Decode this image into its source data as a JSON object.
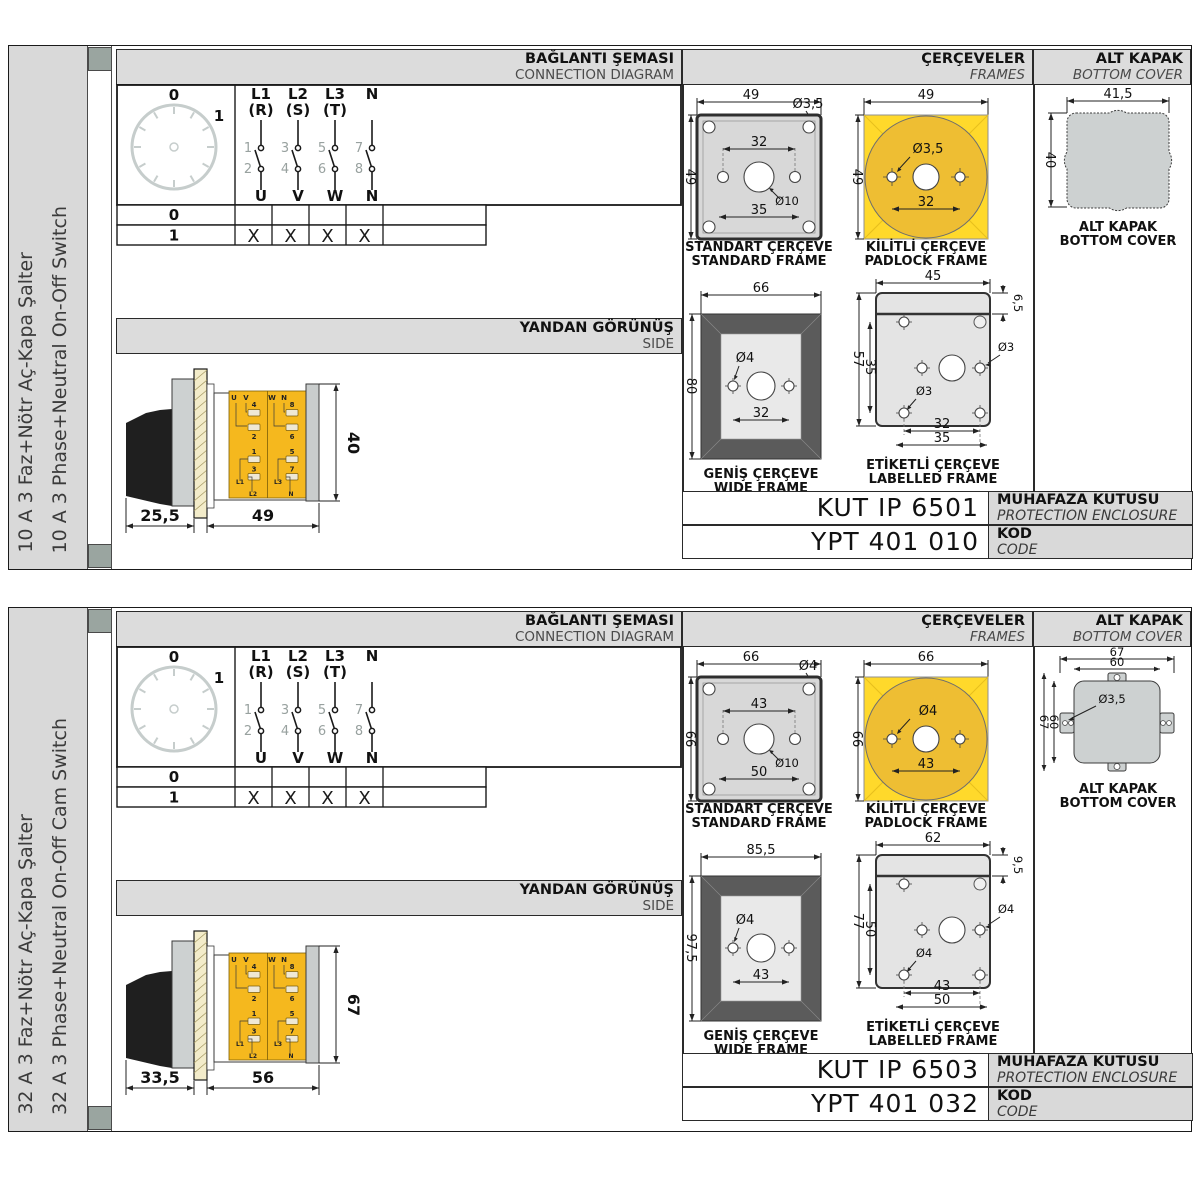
{
  "colors": {
    "panel_grey": "#d9d9d9",
    "header_grey": "#dcdcdc",
    "tab_grey": "#9aa5a0",
    "accent_yellow": "#ffd92b",
    "circle_yellow": "#eebe33",
    "terminal_yellow": "#f5b81e",
    "wide_frame_dark": "#5b5b5b",
    "line_dark": "#1a1a1a",
    "dim_grey": "#98a19f",
    "cover_grey": "#cdd1d1"
  },
  "products": [
    {
      "sidebar": {
        "tr": "10 A 3 Faz+Nötr Aç-Kapa Şalter",
        "en": "10 A 3 Phase+Neutral On-Off Switch"
      },
      "hdr": {
        "conn_tr": "BAĞLANTI ŞEMASI",
        "conn_en": "CONNECTION DIAGRAM",
        "frames_tr": "ÇERÇEVELER",
        "frames_en": "FRAMES",
        "cover_tr": "ALT KAPAK",
        "cover_en": "BOTTOM COVER",
        "side_tr": "YANDAN GÖRÜNÜŞ",
        "side_en": "SIDE"
      },
      "dial": {
        "off": "0",
        "on": "1"
      },
      "poles": {
        "p1": "L1",
        "p1b": "(R)",
        "p2": "L2",
        "p2b": "(S)",
        "p3": "L3",
        "p3b": "(T)",
        "p4": "N",
        "p4b": "",
        "c1": "1",
        "c2": "2",
        "c3": "3",
        "c4": "4",
        "c5": "5",
        "c6": "6",
        "c7": "7",
        "c8": "8",
        "o1": "U",
        "o2": "V",
        "o3": "W",
        "o4": "N"
      },
      "table": {
        "r0": "0",
        "r1": "1",
        "m1": "X",
        "m2": "X",
        "m3": "X",
        "m4": "X"
      },
      "side": {
        "d_left": "25,5",
        "d_w": "49",
        "d_h": "40",
        "u": "U",
        "v": "V",
        "w": "W",
        "n": "N",
        "n1": "1",
        "n2": "2",
        "n3": "3",
        "n4": "4",
        "n5": "5",
        "n6": "6",
        "n7": "7",
        "n8": "8",
        "l1": "L1",
        "l2": "L2",
        "l3": "L3",
        "ln": "N"
      },
      "std": {
        "tr": "STANDART ÇERÇEVE",
        "en": "STANDARD FRAME",
        "w": "49",
        "h": "49",
        "hole": "Ø3,5",
        "inner": "32",
        "center": "Ø10",
        "outer": "35"
      },
      "pad": {
        "tr": "KİLİTLİ ÇERÇEVE",
        "en": "PADLOCK FRAME",
        "w": "49",
        "h": "49",
        "hole": "Ø3,5",
        "inner": "32"
      },
      "wide": {
        "tr": "GENİŞ ÇERÇEVE",
        "en": "WIDE FRAME",
        "w": "66",
        "h": "80",
        "hole": "Ø4",
        "inner": "32"
      },
      "lab": {
        "tr": "ETİKETLİ ÇERÇEVE",
        "en": "LABELLED FRAME",
        "w": "45",
        "strip": "6,5",
        "h": "57",
        "h2": "35",
        "hole1": "Ø3",
        "hole2": "Ø3",
        "b1": "32",
        "b2": "35"
      },
      "cover": {
        "tr": "ALT KAPAK",
        "en": "BOTTOM COVER",
        "variant": "plain",
        "w": "41,5",
        "h": "40"
      },
      "codes": {
        "kut": "KUT IP 6501",
        "enc_tr": "MUHAFAZA KUTUSU",
        "enc_en": "PROTECTION ENCLOSURE",
        "ypt": "YPT 401 010",
        "kod_tr": "KOD",
        "kod_en": "CODE"
      }
    },
    {
      "sidebar": {
        "tr": "32 A 3 Faz+Nötr Aç-Kapa Şalter",
        "en": "32 A 3 Phase+Neutral On-Off Cam Switch"
      },
      "hdr": {
        "conn_tr": "BAĞLANTI ŞEMASI",
        "conn_en": "CONNECTION DIAGRAM",
        "frames_tr": "ÇERÇEVELER",
        "frames_en": "FRAMES",
        "cover_tr": "ALT KAPAK",
        "cover_en": "BOTTOM COVER",
        "side_tr": "YANDAN GÖRÜNÜŞ",
        "side_en": "SIDE"
      },
      "dial": {
        "off": "0",
        "on": "1"
      },
      "poles": {
        "p1": "L1",
        "p1b": "(R)",
        "p2": "L2",
        "p2b": "(S)",
        "p3": "L3",
        "p3b": "(T)",
        "p4": "N",
        "p4b": "",
        "c1": "1",
        "c2": "2",
        "c3": "3",
        "c4": "4",
        "c5": "5",
        "c6": "6",
        "c7": "7",
        "c8": "8",
        "o1": "U",
        "o2": "V",
        "o3": "W",
        "o4": "N"
      },
      "table": {
        "r0": "0",
        "r1": "1",
        "m1": "X",
        "m2": "X",
        "m3": "X",
        "m4": "X"
      },
      "side": {
        "d_left": "33,5",
        "d_w": "56",
        "d_h": "67",
        "u": "U",
        "v": "V",
        "w": "W",
        "n": "N",
        "n1": "1",
        "n2": "2",
        "n3": "3",
        "n4": "4",
        "n5": "5",
        "n6": "6",
        "n7": "7",
        "n8": "8",
        "l1": "L1",
        "l2": "L2",
        "l3": "L3",
        "ln": "N"
      },
      "std": {
        "tr": "STANDART ÇERÇEVE",
        "en": "STANDARD FRAME",
        "w": "66",
        "h": "66",
        "hole": "Ø4",
        "inner": "43",
        "center": "Ø10",
        "outer": "50"
      },
      "pad": {
        "tr": "KİLİTLİ ÇERÇEVE",
        "en": "PADLOCK FRAME",
        "w": "66",
        "h": "66",
        "hole": "Ø4",
        "inner": "43"
      },
      "wide": {
        "tr": "GENİŞ ÇERÇEVE",
        "en": "WIDE FRAME",
        "w": "85,5",
        "h": "97,5",
        "hole": "Ø4",
        "inner": "43"
      },
      "lab": {
        "tr": "ETİKETLİ ÇERÇEVE",
        "en": "LABELLED FRAME",
        "w": "62",
        "strip": "9,5",
        "h": "77",
        "h2": "50",
        "hole1": "Ø4",
        "hole2": "Ø4",
        "b1": "43",
        "b2": "50"
      },
      "cover": {
        "tr": "ALT KAPAK",
        "en": "BOTTOM COVER",
        "variant": "tabs",
        "w_out": "67",
        "w_in": "60",
        "h_out": "67",
        "h_in": "60",
        "hole": "Ø3,5"
      },
      "codes": {
        "kut": "KUT IP 6503",
        "enc_tr": "MUHAFAZA KUTUSU",
        "enc_en": "PROTECTION ENCLOSURE",
        "ypt": "YPT 401 032",
        "kod_tr": "KOD",
        "kod_en": "CODE"
      }
    }
  ]
}
